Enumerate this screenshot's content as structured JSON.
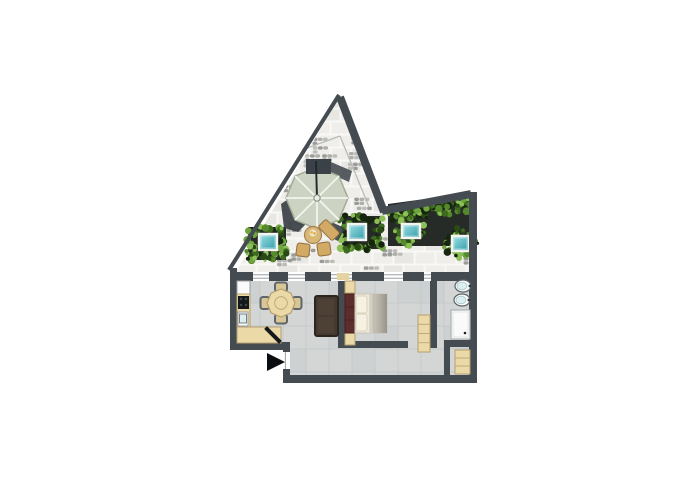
{
  "canvas": {
    "width": 700,
    "height": 500,
    "background": "#ffffff"
  },
  "palette": {
    "wall": "#454c51",
    "wall_dark": "#333a3e",
    "stone": "#f0efeb",
    "stone_tile_a": "#e8e7e3",
    "stone_tile_b": "#efeeea",
    "stone_joint": "#f8f8f6",
    "pebble_a": "#aeafab",
    "pebble_b": "#bcbdb9",
    "pebble_c": "#9b9c98",
    "floor": "#d4d6d6",
    "floor_tile": "#cbcece",
    "floor_joint": "#c5c8c8",
    "beige": "#ecd9a8",
    "beige_border": "#b5a070",
    "threshold": "#e6d3a2",
    "white": "#fafafa",
    "appliance_border": "#9aa0a3",
    "cooktop": "#16191c",
    "knob": "#41474c",
    "sofa": "#453931",
    "sofa_dark": "#2c241e",
    "sofa_cushion": "#4d4136",
    "headboard": "#5d2c2c",
    "headboard_dark": "#47201f",
    "mattress": "#f0ebdc",
    "mattress_border": "#c9c4b4",
    "pillow": "#f6f1e2",
    "pillow_border": "#d8d2bf",
    "duvet_light": "#d9d5c8",
    "duvet_dark": "#98948b",
    "duvet_line": "#b5b1a6",
    "umbrella": "#ccd3c2",
    "umbrella_edge": "#a3ac97",
    "umbrella_rib": "#f2f5ee",
    "pole": "#23282c",
    "block": "#3b4247",
    "shadow": "#394044",
    "tan": "#d8b77a",
    "tan_border": "#a8834e",
    "chair_tan": "#d2aa66",
    "chair_border": "#8f6f3e",
    "food_a": "#e8b932",
    "food_b": "#d99a28",
    "plate": "#f0e6cc",
    "soil": "#262b28",
    "glass_light": "#9fe2e6",
    "glass_dark": "#2f9aa8",
    "glass_frame": "#f4f5f3",
    "greens": [
      "#16250e",
      "#294a15",
      "#3e6a1f",
      "#55892c",
      "#6fa53f",
      "#8cbf55"
    ],
    "sink_rim": "#5b6468",
    "sink_inner": "#dceef0",
    "shower_border": "#aeb2b2",
    "shower_inner": "#e2e4e4",
    "sill": "#9aa0a3",
    "arrow": "#0b0e10",
    "roof_line": "#b9bcb8"
  },
  "plan": {
    "paving_polygon": [
      [
        237,
        270
      ],
      [
        338,
        100
      ],
      [
        381,
        210
      ],
      [
        385,
        207
      ],
      [
        469,
        196
      ],
      [
        469,
        274
      ],
      [
        237,
        274
      ]
    ],
    "interior_polygon": [
      [
        237,
        280
      ],
      [
        469,
        280
      ],
      [
        469,
        376
      ],
      [
        290,
        376
      ],
      [
        290,
        349
      ],
      [
        237,
        349
      ]
    ],
    "roof_lines": [
      [
        [
          302,
          150
        ],
        [
          340,
          136
        ]
      ],
      [
        [
          340,
          136
        ],
        [
          369,
          207
        ]
      ]
    ],
    "walls": [
      {
        "name": "triangle-left-wall",
        "type": "line",
        "x1": 339,
        "y1": 95,
        "x2": 229,
        "y2": 270,
        "w": 4
      },
      {
        "name": "triangle-right-wall",
        "type": "line",
        "x1": 340,
        "y1": 97,
        "x2": 384,
        "y2": 212,
        "w": 8
      },
      {
        "name": "roof-top-right-wall",
        "type": "line",
        "x1": 382,
        "y1": 211,
        "x2": 471,
        "y2": 194,
        "w": 8
      },
      {
        "name": "right-wall",
        "type": "rect",
        "x": 469,
        "y": 192,
        "w": 8,
        "h": 191
      },
      {
        "name": "bottom-wall",
        "type": "rect",
        "x": 283,
        "y": 375,
        "w": 194,
        "h": 8
      },
      {
        "name": "entry-side-wall",
        "type": "rect",
        "x": 283,
        "y": 348,
        "w": 7,
        "h": 30
      },
      {
        "name": "kitchen-bottom-wall",
        "type": "rect",
        "x": 230,
        "y": 342,
        "w": 60,
        "h": 8
      },
      {
        "name": "left-wall",
        "type": "rect",
        "x": 230,
        "y": 268,
        "w": 7,
        "h": 78
      },
      {
        "name": "living-bedroom-wall",
        "type": "rect",
        "x": 338,
        "y": 281,
        "w": 7,
        "h": 67
      },
      {
        "name": "bed-foot-wall",
        "type": "rect",
        "x": 338,
        "y": 341,
        "w": 70,
        "h": 7
      },
      {
        "name": "bathroom-wall",
        "type": "rect",
        "x": 430,
        "y": 273,
        "w": 7,
        "h": 75
      },
      {
        "name": "bathroom-bottom-wall",
        "type": "rect",
        "x": 444,
        "y": 340,
        "w": 26,
        "h": 7
      },
      {
        "name": "closet-wall",
        "type": "rect",
        "x": 444,
        "y": 347,
        "w": 6,
        "h": 31
      }
    ],
    "top_wall": {
      "y": 272,
      "h": 9,
      "segments": [
        [
          230,
          253
        ],
        [
          269,
          288
        ],
        [
          305,
          331
        ],
        [
          352,
          384
        ],
        [
          403,
          424
        ],
        [
          431,
          469
        ]
      ],
      "windows": [
        [
          253,
          269
        ],
        [
          288,
          305
        ],
        [
          331,
          352
        ],
        [
          384,
          403
        ],
        [
          424,
          431
        ]
      ],
      "door_threshold": [
        337,
        349
      ]
    },
    "entry_door_gap": {
      "x": 283,
      "y": 352,
      "w": 7,
      "h": 17
    },
    "planters": [
      {
        "name": "planter-left",
        "bed": {
          "type": "rect",
          "x": 248,
          "y": 227,
          "w": 38,
          "h": 33
        },
        "skylights": [
          {
            "x": 259,
            "y": 234,
            "w": 18,
            "h": 16
          }
        ],
        "mode": "ring",
        "seed": 7
      },
      {
        "name": "planter-middle",
        "bed": {
          "type": "rect",
          "x": 342,
          "y": 216,
          "w": 39,
          "h": 33
        },
        "skylights": [
          {
            "x": 348,
            "y": 224,
            "w": 18,
            "h": 16
          }
        ],
        "mode": "ring",
        "seed": 11
      },
      {
        "name": "planter-right",
        "bed": {
          "type": "poly",
          "points": [
            [
              388,
              204
            ],
            [
              469,
              193
            ],
            [
              469,
              252
            ],
            [
              452,
              252
            ],
            [
              452,
              246
            ],
            [
              388,
              246
            ]
          ]
        },
        "skylights": [
          {
            "x": 402,
            "y": 224,
            "w": 18,
            "h": 14
          },
          {
            "x": 452,
            "y": 236,
            "w": 17,
            "h": 15
          }
        ],
        "mode": "band",
        "band": [
          [
            390,
            211
          ],
          [
            466,
            199
          ]
        ],
        "seed": 23
      }
    ],
    "umbrella": {
      "cx": 317,
      "cy": 198,
      "r": 31,
      "pole_top": 161,
      "block": {
        "x": 306,
        "y": 159,
        "w": 25,
        "h": 15
      },
      "block_shadow": [
        [
          331,
          162
        ],
        [
          352,
          171
        ],
        [
          349,
          182
        ],
        [
          331,
          174
        ]
      ],
      "shadow_polygon": [
        [
          281,
          204
        ],
        [
          300,
          191
        ],
        [
          308,
          222
        ],
        [
          298,
          232
        ],
        [
          284,
          228
        ]
      ],
      "shadow_right": [
        [
          329,
          221
        ],
        [
          345,
          228
        ],
        [
          338,
          241
        ],
        [
          326,
          235
        ]
      ]
    },
    "terrace_seating": {
      "table": {
        "cx": 313,
        "cy": 235,
        "r": 8.5
      },
      "chairs": [
        {
          "cx": 303,
          "cy": 250,
          "rot": 8
        },
        {
          "cx": 324,
          "cy": 249,
          "rot": -8
        }
      ],
      "lounge": {
        "cx": 329,
        "cy": 230,
        "w": 20,
        "h": 11,
        "rot": 45
      }
    },
    "kitchen": {
      "fridge": {
        "x": 237,
        "y": 281,
        "w": 13,
        "h": 13
      },
      "counter_v": {
        "x": 237,
        "y": 294,
        "w": 13,
        "h": 49
      },
      "counter_h": {
        "x": 237,
        "y": 327,
        "w": 44,
        "h": 16
      },
      "cooktop": {
        "x": 238,
        "y": 296,
        "w": 11,
        "h": 13
      },
      "sink": {
        "x": 238,
        "y": 312,
        "w": 10,
        "h": 14
      },
      "door_leaf": {
        "cx": 273,
        "cy": 335,
        "w": 4,
        "h": 21,
        "rot": -45
      }
    },
    "dining": {
      "table": {
        "cx": 281,
        "cy": 303,
        "r": 14
      },
      "chairs": [
        {
          "cx": 281,
          "cy": 287,
          "rot": 0
        },
        {
          "cx": 281,
          "cy": 319,
          "rot": 0
        },
        {
          "cx": 265,
          "cy": 303,
          "rot": 90
        },
        {
          "cx": 297,
          "cy": 303,
          "rot": 90
        }
      ]
    },
    "sofa": {
      "x": 315,
      "y": 296,
      "w": 23,
      "h": 40
    },
    "bed": {
      "nightstands": [
        {
          "x": 345,
          "y": 281,
          "w": 10,
          "h": 12
        },
        {
          "x": 345,
          "y": 333,
          "w": 10,
          "h": 12
        }
      ],
      "headboard": {
        "x": 345,
        "y": 294,
        "w": 10,
        "h": 39
      },
      "mattress": {
        "x": 355,
        "y": 294,
        "w": 32,
        "h": 39
      },
      "pillows": [
        {
          "x": 356,
          "y": 296,
          "w": 11,
          "h": 17
        },
        {
          "x": 356,
          "y": 314,
          "w": 11,
          "h": 17
        }
      ],
      "duvet": {
        "x": 369,
        "y": 294,
        "w": 18,
        "h": 39
      }
    },
    "wardrobe": {
      "x": 418,
      "y": 315,
      "w": 12,
      "h": 37,
      "shelves": 3
    },
    "bathroom": {
      "sinks": [
        {
          "cx": 463,
          "cy": 286,
          "rx": 8,
          "ry": 6
        },
        {
          "cx": 462,
          "cy": 300,
          "rx": 8,
          "ry": 6
        }
      ],
      "shower": {
        "x": 451,
        "y": 310,
        "w": 19,
        "h": 29,
        "drain": [
          465,
          333
        ]
      }
    },
    "closet": {
      "x": 455,
      "y": 350,
      "w": 15,
      "h": 24,
      "shelves": 2
    },
    "entrance_arrow": [
      [
        267,
        353
      ],
      [
        285,
        362
      ],
      [
        267,
        371
      ]
    ]
  }
}
